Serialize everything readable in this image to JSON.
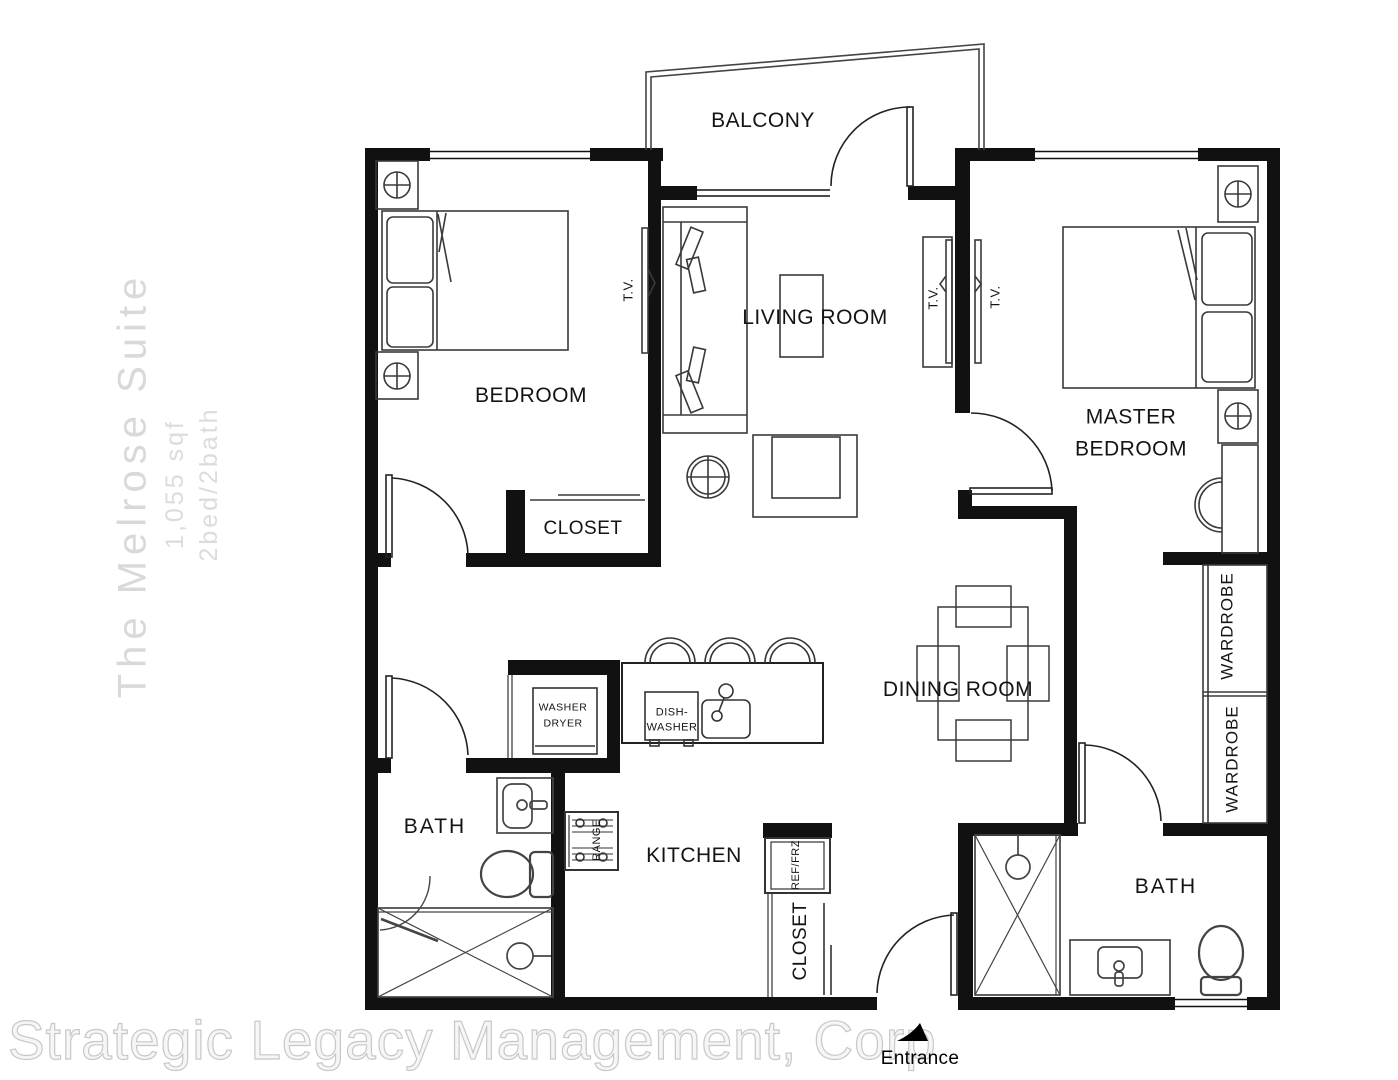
{
  "watermark": {
    "title": "The Melrose Suite",
    "area": "1,055 sqf",
    "config": "2bed/2bath",
    "company": "Strategic Legacy Management, Corp"
  },
  "labels": {
    "balcony": "BALCONY",
    "bedroom": "BEDROOM",
    "living_room": "LIVING ROOM",
    "master_bedroom": "MASTER\nBEDROOM",
    "bedroom_closet": "CLOSET",
    "dining_room": "DINING ROOM",
    "wardrobe_upper": "WARDROBE",
    "wardrobe_lower": "WARDROBE",
    "bath_left": "BATH",
    "bath_right": "BATH",
    "kitchen": "KITCHEN",
    "entry_closet": "CLOSET",
    "washer_dryer": "WASHER\nDRYER",
    "dishwasher": "DISH-\nWASHER",
    "range": "RANGE",
    "refrigerator": "REF/FRZ",
    "tv_bedroom": "T.V.",
    "tv_living": "T.V.",
    "tv_master": "T.V.",
    "entrance": "Entrance"
  },
  "colors": {
    "wall": "#111111",
    "furniture_line": "#3a3a3a",
    "door_line": "#222222",
    "watermark_gray": "#d9d9d9"
  }
}
